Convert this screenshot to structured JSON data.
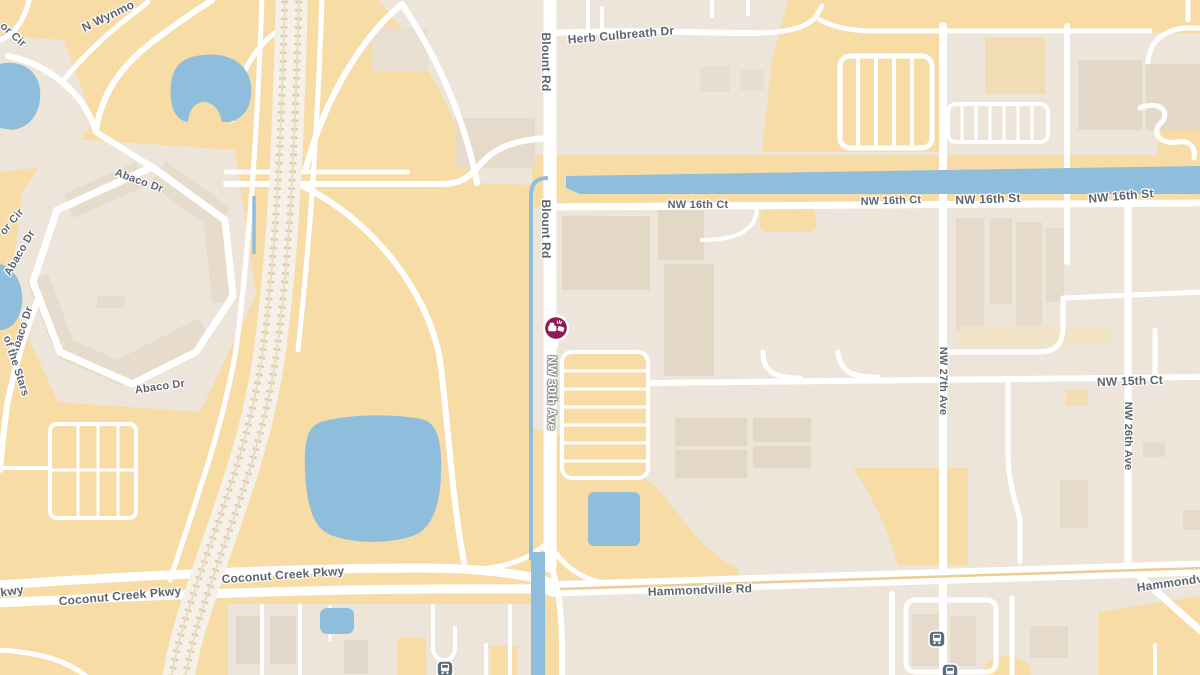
{
  "map": {
    "kind": "street-map",
    "colors": {
      "land_open": "#F8DCA6",
      "land_urban": "#EDE5D9",
      "building": "#E3D7C5",
      "water": "#8FBEDC",
      "road": "#FFFFFF",
      "label_text": "#5D646F",
      "marker": "#8F1A56",
      "transit_icon": "#5C6D7C"
    },
    "marker": {
      "name": "crash-incident-marker",
      "x": 556,
      "y": 329,
      "color": "#8F1A56"
    },
    "transit_stations": [
      {
        "x": 937,
        "y": 639
      },
      {
        "x": 950,
        "y": 672
      },
      {
        "x": 445,
        "y": 669
      }
    ],
    "road_labels": [
      {
        "text": "or Cir",
        "x": 13,
        "y": 35,
        "rot": 42,
        "size": 11
      },
      {
        "text": "N Wynmo",
        "x": 108,
        "y": 16,
        "rot": -26,
        "size": 12
      },
      {
        "text": "Abaco Dr",
        "x": 139,
        "y": 181,
        "rot": 20,
        "size": 11
      },
      {
        "text": "or Cir",
        "x": 12,
        "y": 222,
        "rot": -50,
        "size": 11
      },
      {
        "text": "Abaco Dr",
        "x": 20,
        "y": 253,
        "rot": -60,
        "size": 11
      },
      {
        "text": "Abaco Dr",
        "x": 22,
        "y": 331,
        "rot": -72,
        "size": 11
      },
      {
        "text": "of the Stars",
        "x": 16,
        "y": 366,
        "rot": 72,
        "size": 11
      },
      {
        "text": "Abaco Dr",
        "x": 160,
        "y": 387,
        "rot": -8,
        "size": 11
      },
      {
        "text": "Blount Rd",
        "x": 546,
        "y": 62,
        "rot": 90,
        "size": 12
      },
      {
        "text": "Herb Culbreath Dr",
        "x": 621,
        "y": 35,
        "rot": -5,
        "size": 12
      },
      {
        "text": "Blount Rd",
        "x": 546,
        "y": 229,
        "rot": 90,
        "size": 12
      },
      {
        "text": "NW 16th Ct",
        "x": 698,
        "y": 205,
        "rot": 0,
        "size": 11
      },
      {
        "text": "NW 16th Ct",
        "x": 891,
        "y": 201,
        "rot": -2,
        "size": 11
      },
      {
        "text": "NW 16th St",
        "x": 988,
        "y": 199,
        "rot": -2,
        "size": 12
      },
      {
        "text": "NW 16th St",
        "x": 1121,
        "y": 196,
        "rot": -5,
        "size": 12
      },
      {
        "text": "NW 30th Ave",
        "x": 552,
        "y": 393,
        "rot": 90,
        "size": 12,
        "variant": "on-road"
      },
      {
        "text": "NW 15th Ct",
        "x": 1130,
        "y": 381,
        "rot": -2,
        "size": 12
      },
      {
        "text": "NW 27th Ave",
        "x": 943,
        "y": 381,
        "rot": 90,
        "size": 11
      },
      {
        "text": "NW 26th Ave",
        "x": 1128,
        "y": 436,
        "rot": 90,
        "size": 11
      },
      {
        "text": "Coconut Creek Pkwy",
        "x": 283,
        "y": 575,
        "rot": -4,
        "size": 12
      },
      {
        "text": "kwy",
        "x": 12,
        "y": 591,
        "rot": -8,
        "size": 12
      },
      {
        "text": "Coconut Creek Pkwy",
        "x": 120,
        "y": 596,
        "rot": -5,
        "size": 12
      },
      {
        "text": "Hammondville Rd",
        "x": 700,
        "y": 590,
        "rot": -2,
        "size": 12
      },
      {
        "text": "Hammondv",
        "x": 1170,
        "y": 583,
        "rot": -8,
        "size": 12
      }
    ]
  }
}
